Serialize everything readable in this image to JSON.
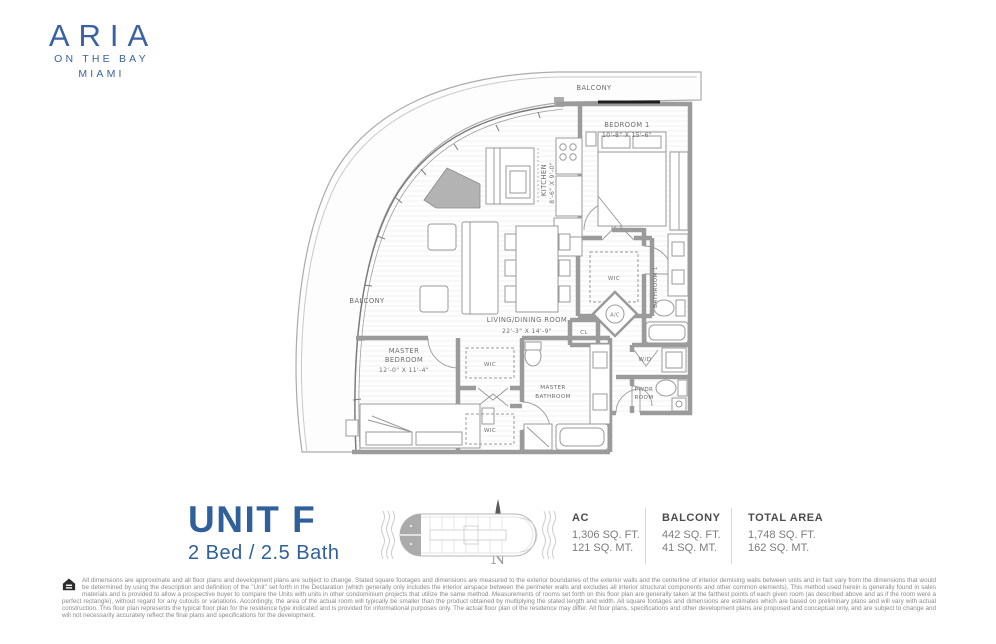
{
  "colors": {
    "brand": "#3A62A2",
    "unit_blue": "#30609C",
    "wall_gray": "#9b9b9b",
    "keyplan_gray": "#ababab"
  },
  "logo": {
    "name": "ARIA",
    "tagline": "ON THE BAY",
    "city": "MIAMI"
  },
  "plan": {
    "balcony_left": "BALCONY",
    "balcony_top": "BALCONY",
    "bedroom1": {
      "name": "BEDROOM 1",
      "dims": "10'-8\" X 15'-6\""
    },
    "kitchen": {
      "name": "KITCHEN",
      "dims": "8'-6\" X 9'-0\""
    },
    "living": {
      "name": "LIVING/DINING ROOM",
      "dims": "22'-3\" X 14'-9\""
    },
    "master_bedroom": {
      "line1": "MASTER",
      "line2": "BEDROOM",
      "dims": "12'-0\" X 11'-4\""
    },
    "master_bath": {
      "line1": "MASTER",
      "line2": "BATHROOM"
    },
    "bathroom1": "BATHROOM 1",
    "wic": "WIC",
    "cl": "CL",
    "ac": "A/C",
    "wd": "W/D",
    "pwdr": {
      "line1": "PWDR",
      "line2": "ROOM"
    }
  },
  "footer": {
    "unit": "UNIT F",
    "config": "2 Bed / 2.5 Bath",
    "north": "N",
    "stats": [
      {
        "label": "AC",
        "sqft": "1,306 SQ. FT.",
        "sqmt": "121 SQ. MT."
      },
      {
        "label": "BALCONY",
        "sqft": "442 SQ. FT.",
        "sqmt": "41 SQ. MT."
      },
      {
        "label": "TOTAL AREA",
        "sqft": "1,748 SQ. FT.",
        "sqmt": "162 SQ. MT."
      }
    ]
  },
  "disclaimer": "All dimensions are approximate and all floor plans and development plans are subject to change. Stated square footages and dimensions are measured to the exterior boundaries of the exterior walls and the centerline of interior demising walls between units and in fact vary from the dimensions that would be determined by using the description and definition of the \"Unit\" set forth in the Declaration (which generally only includes the interior airspace between the perimeter walls and excludes all interior structural components and other common elements). This method used herein is generally found in sales materials and is provided to allow a prospective buyer to compare the Units with units in other condominium projects that utilize the same method. Measurements of rooms set forth on this floor plan are generally taken at the farthest points of each given room (as described above and as if the room were a perfect rectangle), without regard for any cutouts or variations. Accordingly, the area of the actual room will typically be smaller than the product obtained by multiplying the stated length and width. All square footages and dimensions are estimates which are based on preliminary plans and will vary with actual construction. This floor plan represents the typical floor plan for the residence type indicated and is provided for informational purposes only. The actual floor plan of the residence may differ. All floor plans, specifications and other development plans are proposed and conceptual only, and are subject to change and will not necessarily accurately reflect the final plans and specifications for the development."
}
